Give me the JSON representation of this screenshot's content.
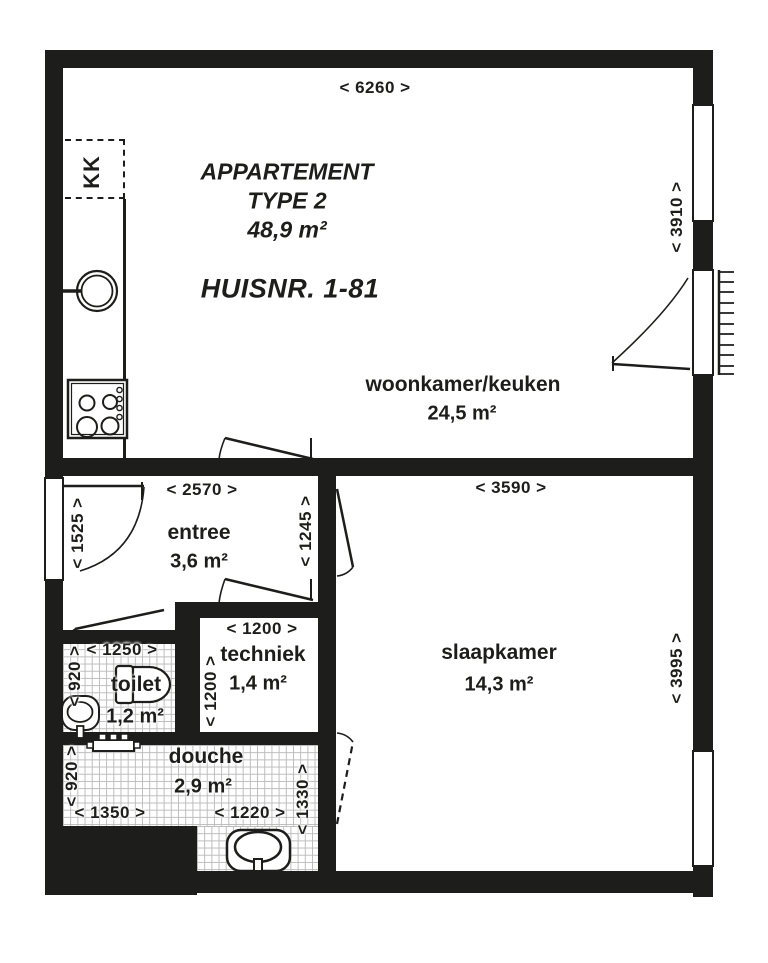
{
  "plan": {
    "title_lines": [
      "APPARTEMENT",
      "TYPE 2",
      "48,9 m²"
    ],
    "house_number": "HUISNR. 1-81",
    "kitchen_unit_label": "KK",
    "rooms": [
      {
        "name": "woonkamer/keuken",
        "area": "24,5 m²"
      },
      {
        "name": "entree",
        "area": "3,6 m²"
      },
      {
        "name": "techniek",
        "area": "1,4 m²"
      },
      {
        "name": "toilet",
        "area": "1,2 m²"
      },
      {
        "name": "douche",
        "area": "2,9 m²"
      },
      {
        "name": "slaapkamer",
        "area": "14,3 m²"
      }
    ],
    "dimensions": {
      "overall_width": "< 6260 >",
      "woonkamer_height": "< 3910 >",
      "entree_width": "< 2570 >",
      "entree_left_height": "< 1525 >",
      "entree_right_height": "< 1245 >",
      "slaapkamer_width": "< 3590 >",
      "slaapkamer_height": "< 3995 >",
      "techniek_width": "< 1200 >",
      "techniek_height": "< 1200 >",
      "toilet_width": "< 1250 >",
      "toilet_height": "< 920 >",
      "douche_height": "< 920 >",
      "douche_width_left": "< 1350 >",
      "douche_width_right": "< 1220 >",
      "douche_right_height": "< 1330 >"
    },
    "symbols": [
      "front-door-swing",
      "balcony-door-swing",
      "interior-door-swing",
      "window",
      "french-balcony-railing",
      "kitchen-sink",
      "cooktop",
      "radiator",
      "toilet-fixture",
      "hand-basin",
      "washbasin"
    ],
    "colors": {
      "wall": "#1d1d1b",
      "line": "#1d1d1b",
      "tile_line": "#bcbcbc",
      "background": "#ffffff"
    }
  }
}
